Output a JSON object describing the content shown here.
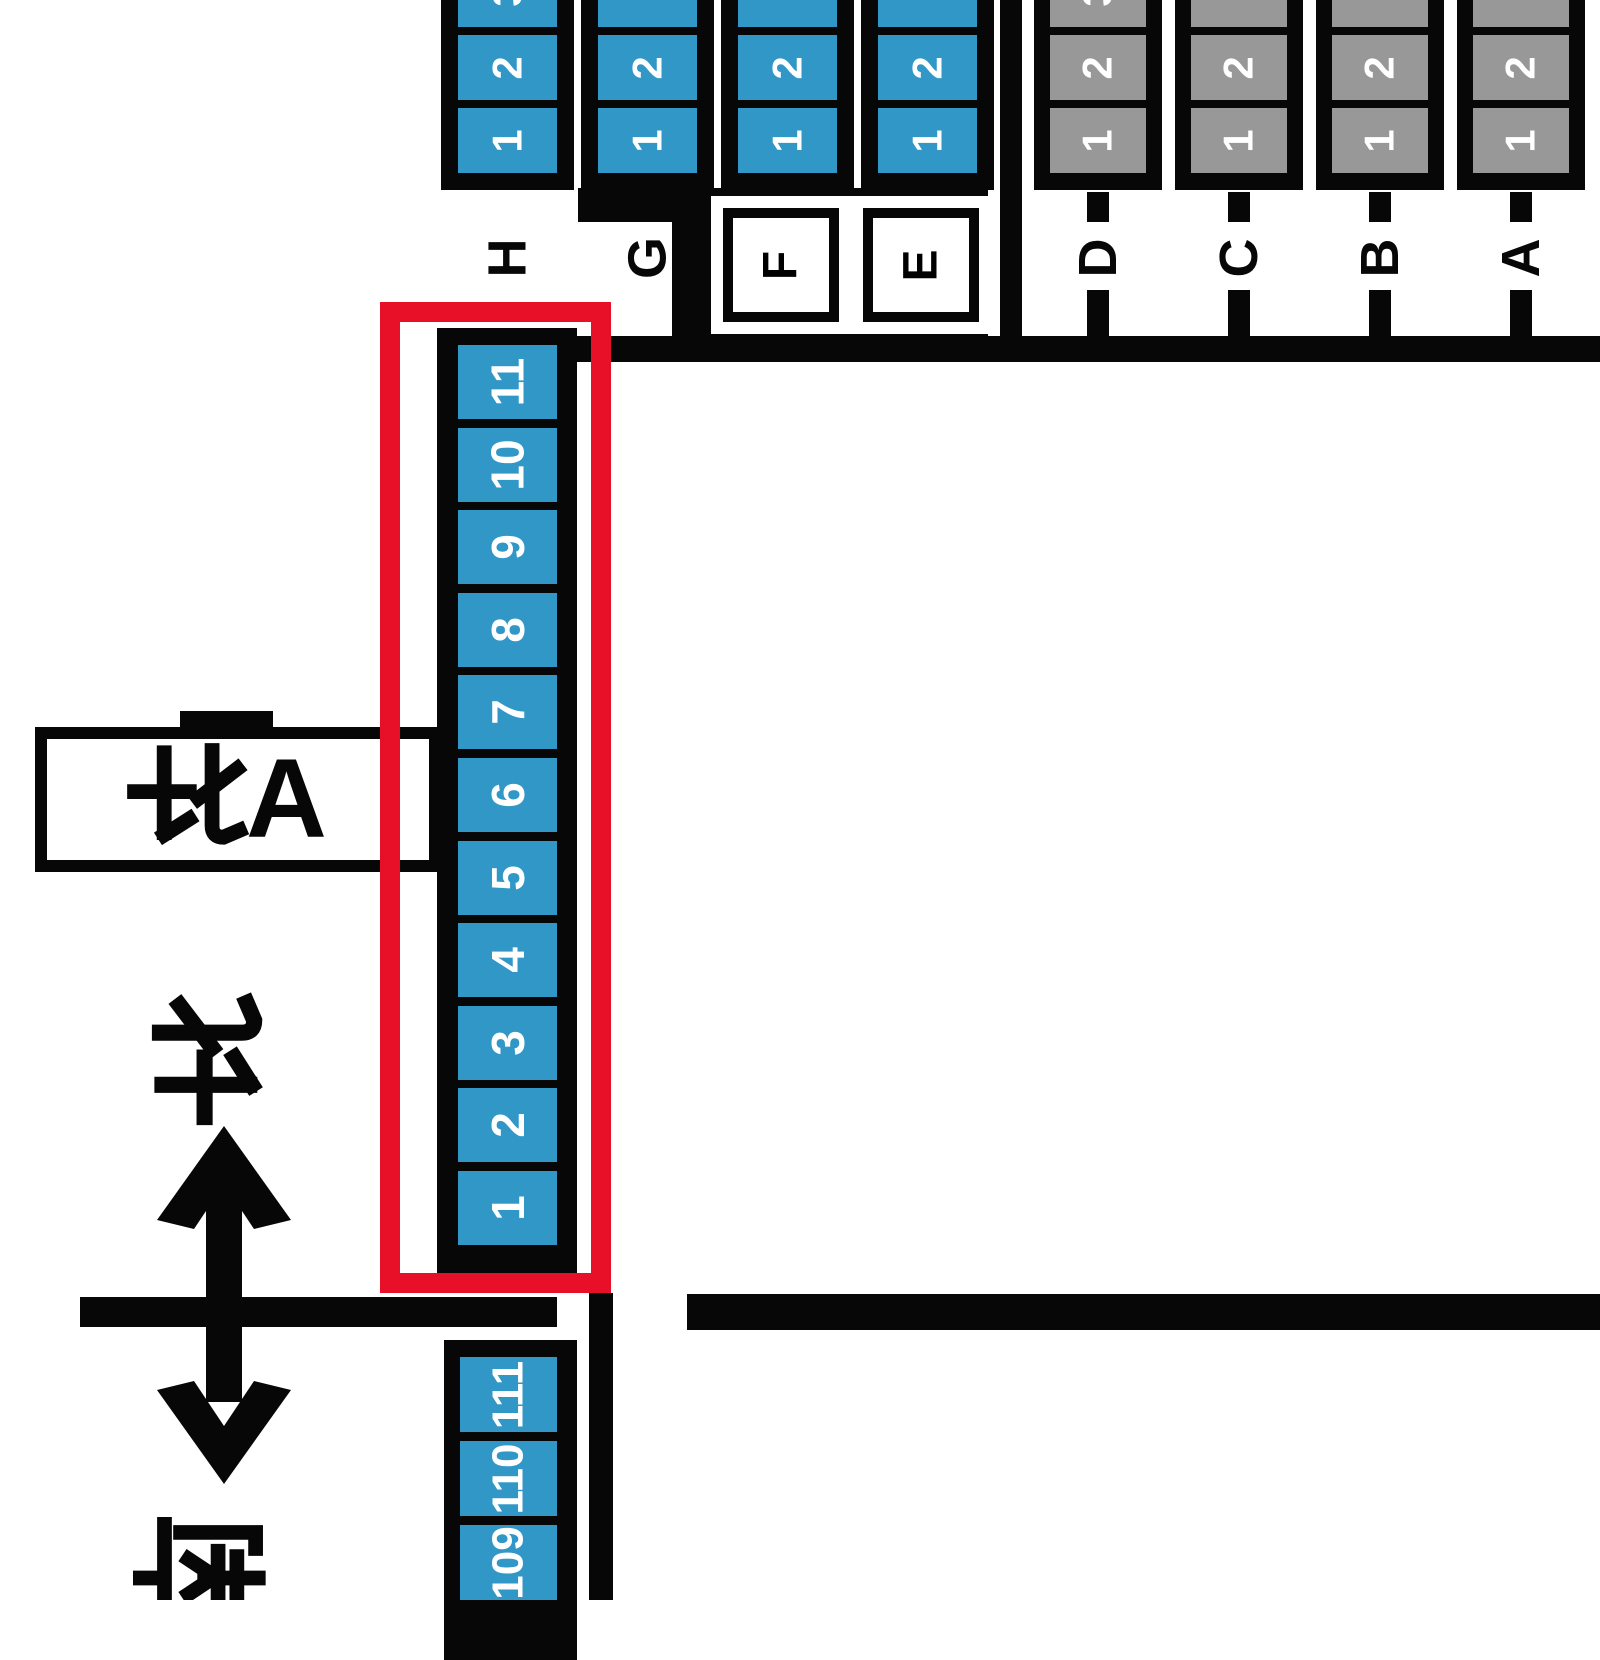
{
  "map_title": "event booth map (cropped view)",
  "colors": {
    "booth_blue": "#3097c6",
    "booth_gray": "#989898",
    "line_black": "#070707",
    "highlight_red": "#e80f28",
    "background": "#ffffff",
    "number_text": "#ffffff"
  },
  "top_left_section": {
    "columns": [
      {
        "label": "H",
        "cells": [
          "1",
          "2",
          "3"
        ]
      },
      {
        "label": "G",
        "cells": [
          "1",
          "2",
          ""
        ]
      },
      {
        "label": "F",
        "cells": [
          "1",
          "2",
          ""
        ],
        "boxed": true
      },
      {
        "label": "E",
        "cells": [
          "1",
          "2",
          ""
        ],
        "boxed": true
      }
    ]
  },
  "top_right_section": {
    "columns": [
      {
        "label": "D",
        "cells": [
          "1",
          "2",
          "3"
        ]
      },
      {
        "label": "C",
        "cells": [
          "1",
          "2",
          ""
        ]
      },
      {
        "label": "B",
        "cells": [
          "1",
          "2",
          ""
        ]
      },
      {
        "label": "A",
        "cells": [
          "1",
          "2",
          ""
        ]
      }
    ]
  },
  "highlighted_area": {
    "label_kanji": "北",
    "label_letter": "A",
    "column_cells": [
      "11",
      "10",
      "9",
      "8",
      "7",
      "6",
      "5",
      "4",
      "3",
      "2",
      "1"
    ]
  },
  "bottom_column": {
    "cells": [
      "111",
      "110",
      "109"
    ]
  },
  "compass": {
    "north": "北",
    "south": "南",
    "icon": "north-south-double-arrow"
  }
}
